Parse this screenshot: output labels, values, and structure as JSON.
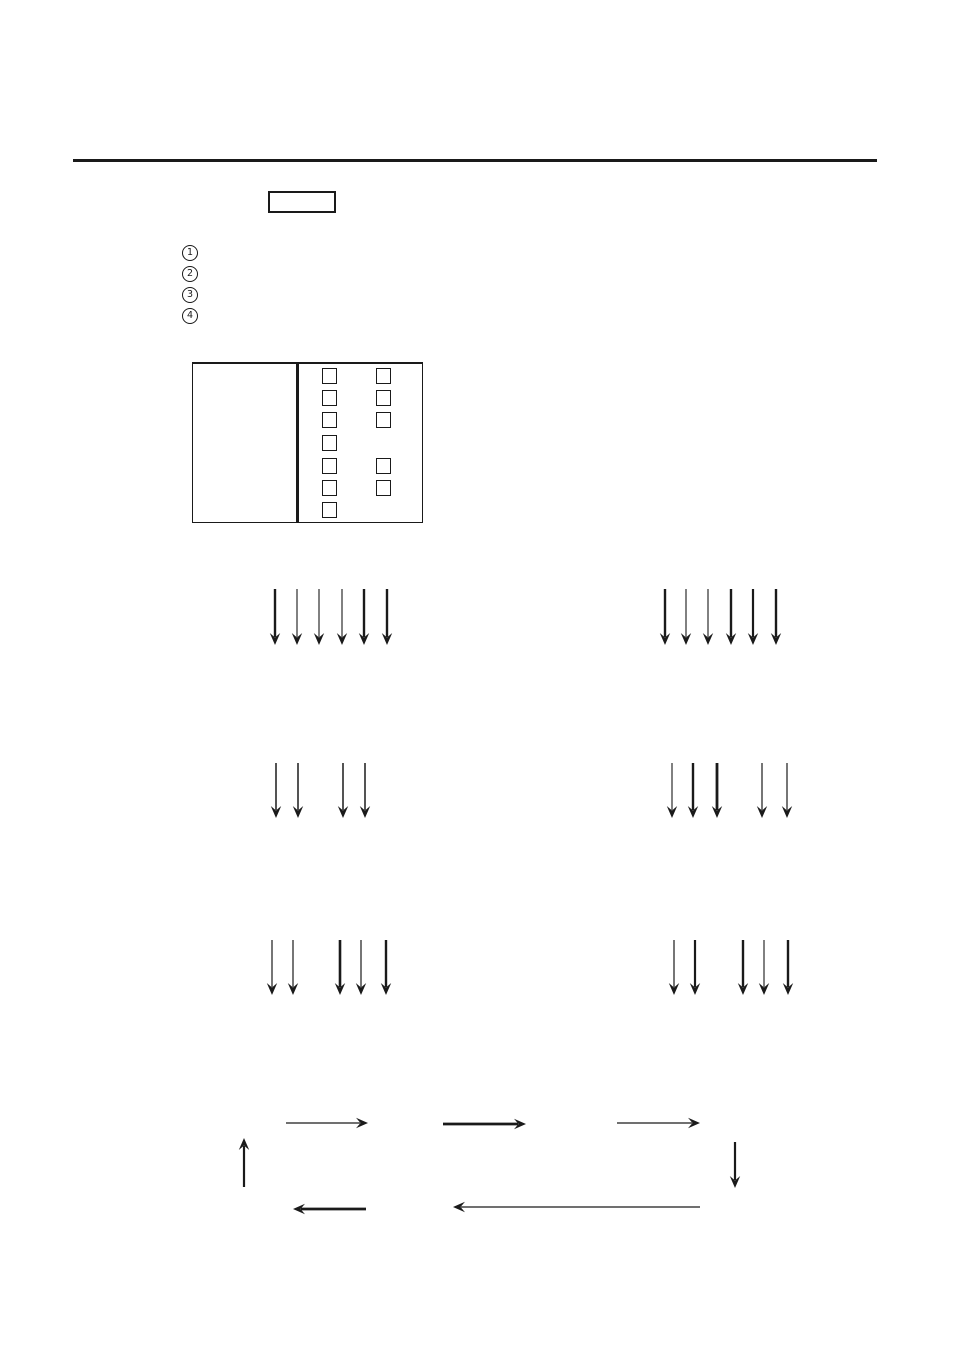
{
  "page": {
    "background": "#ffffff",
    "ink": "#1a1a1a"
  },
  "top_rule": {
    "color": "#1a1a1a"
  },
  "label_box": {
    "text": ""
  },
  "circled_numbers": [
    {
      "label": "1"
    },
    {
      "label": "2"
    },
    {
      "label": "3"
    },
    {
      "label": "4"
    }
  ],
  "panel_diagram": {
    "squares": {
      "size": {
        "w": 15,
        "h": 16
      },
      "left_column_x": 322,
      "right_column_x": 376,
      "row_ys": [
        368,
        390,
        412,
        435,
        458,
        480,
        502
      ],
      "left_rows": [
        0,
        1,
        2,
        3,
        4,
        5,
        6
      ],
      "right_rows": [
        0,
        1,
        2,
        4,
        5
      ]
    }
  },
  "down_arrow_groups": [
    {
      "name": "row1-left",
      "y1": 589,
      "y2": 645,
      "arrows": [
        {
          "x": 275,
          "w": 2.4
        },
        {
          "x": 297,
          "w": 1.1
        },
        {
          "x": 319,
          "w": 1.1
        },
        {
          "x": 342,
          "w": 1.1
        },
        {
          "x": 364,
          "w": 2.4
        },
        {
          "x": 387,
          "w": 2.4
        }
      ]
    },
    {
      "name": "row1-right",
      "y1": 589,
      "y2": 645,
      "arrows": [
        {
          "x": 665,
          "w": 2.4
        },
        {
          "x": 686,
          "w": 1.1
        },
        {
          "x": 708,
          "w": 1.1
        },
        {
          "x": 731,
          "w": 2.4
        },
        {
          "x": 753,
          "w": 2.2
        },
        {
          "x": 776,
          "w": 2.4
        }
      ]
    },
    {
      "name": "row2-left",
      "y1": 763,
      "y2": 818,
      "arrows": [
        {
          "x": 276,
          "w": 1.5
        },
        {
          "x": 298,
          "w": 1.5
        },
        {
          "x": 343,
          "w": 1.5
        },
        {
          "x": 365,
          "w": 1.5
        }
      ]
    },
    {
      "name": "row2-right",
      "y1": 763,
      "y2": 818,
      "arrows": [
        {
          "x": 672,
          "w": 1.1
        },
        {
          "x": 693,
          "w": 2.4
        },
        {
          "x": 717,
          "w": 2.8
        },
        {
          "x": 762,
          "w": 1.2
        },
        {
          "x": 787,
          "w": 1.2
        }
      ]
    },
    {
      "name": "row3-left",
      "y1": 940,
      "y2": 995,
      "arrows": [
        {
          "x": 272,
          "w": 1.2
        },
        {
          "x": 293,
          "w": 1.2
        },
        {
          "x": 340,
          "w": 2.6
        },
        {
          "x": 361,
          "w": 1.2
        },
        {
          "x": 386,
          "w": 2.4
        }
      ]
    },
    {
      "name": "row3-right",
      "y1": 940,
      "y2": 995,
      "arrows": [
        {
          "x": 674,
          "w": 1.2
        },
        {
          "x": 695,
          "w": 2.2
        },
        {
          "x": 743,
          "w": 2.4
        },
        {
          "x": 764,
          "w": 1.1
        },
        {
          "x": 788,
          "w": 2.4
        }
      ]
    }
  ],
  "cycle_arrows": [
    {
      "name": "cycle-up-arrow",
      "x1": 244,
      "y1": 1187,
      "x2": 244,
      "y2": 1138,
      "w": 2.2
    },
    {
      "name": "cycle-right-arrow-1",
      "x1": 286,
      "y1": 1123,
      "x2": 368,
      "y2": 1123,
      "w": 1.2
    },
    {
      "name": "cycle-right-arrow-2",
      "x1": 443,
      "y1": 1124,
      "x2": 526,
      "y2": 1124,
      "w": 2.8
    },
    {
      "name": "cycle-right-arrow-3",
      "x1": 617,
      "y1": 1123,
      "x2": 700,
      "y2": 1123,
      "w": 1.2
    },
    {
      "name": "cycle-down-arrow",
      "x1": 735,
      "y1": 1142,
      "x2": 735,
      "y2": 1188,
      "w": 2.2
    },
    {
      "name": "cycle-left-arrow-short",
      "x1": 366,
      "y1": 1209,
      "x2": 293,
      "y2": 1209,
      "w": 2.8
    },
    {
      "name": "cycle-left-arrow-long",
      "x1": 700,
      "y1": 1207,
      "x2": 453,
      "y2": 1207,
      "w": 1.2
    }
  ]
}
